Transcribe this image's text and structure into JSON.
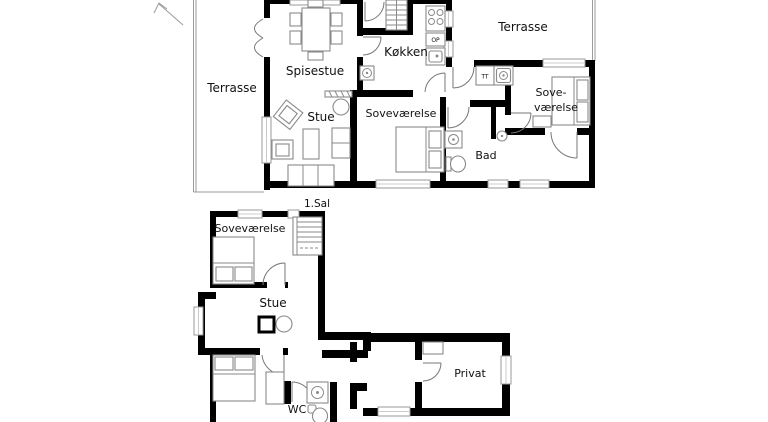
{
  "upper_floor": {
    "terrace_left": "Terrasse",
    "terrace_right": "Terrasse",
    "dining_room": "Spisestue",
    "living_room": "Stue",
    "kitchen": "Køkken",
    "bedroom_center": "Soveværelse",
    "bedroom_right_line1": "Sove-",
    "bedroom_right_line2": "værelse",
    "bathroom": "Bad",
    "dishwasher_label": "OP",
    "dryer_label": "TT"
  },
  "floor_caption": "1.Sal",
  "lower_floor": {
    "bedroom": "Soveværelse",
    "living_room": "Stue",
    "wc": "WC",
    "private_room": "Privat"
  },
  "colors": {
    "wall": "#000000",
    "furniture_outline": "#8a8a8a",
    "background": "#ffffff",
    "text": "#111111"
  }
}
